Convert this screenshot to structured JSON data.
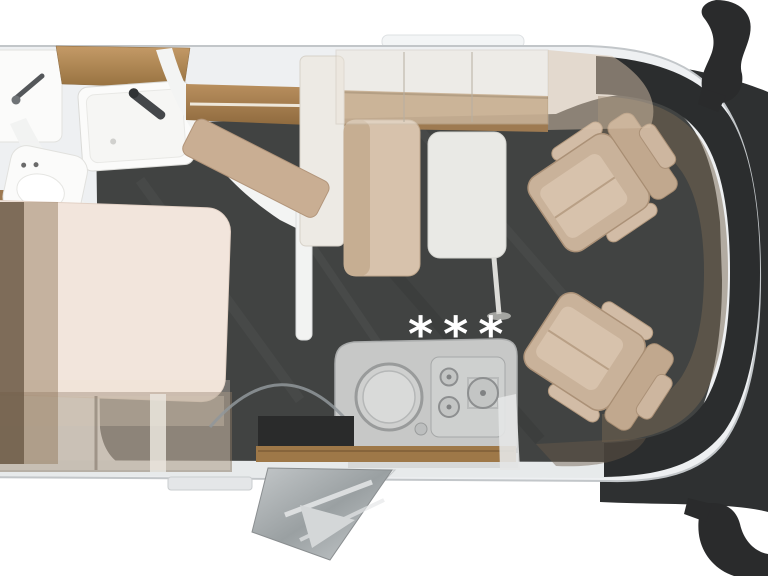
{
  "scene": {
    "type": "motorhome-floorplan-overhead-render",
    "vehicle_front": "right",
    "vehicle_rear": "left-cropped"
  },
  "kitchen": {
    "hob_symbols": "***",
    "items": [
      "counter",
      "round-sink",
      "hob-3-burner"
    ]
  },
  "areas": {
    "bathroom": {
      "items": [
        "washbasin",
        "vanity-cabinet",
        "shower-tray",
        "shower-faucet",
        "toilet",
        "partition-wall"
      ]
    },
    "bedroom": {
      "items": [
        "bed",
        "wardrobe",
        "storage-shelves"
      ]
    },
    "lounge": {
      "items": [
        "sideboard",
        "bench-backrest",
        "bench-seat",
        "corner-cushion",
        "table",
        "overhead-lockers",
        "drop-down-bed"
      ]
    },
    "entrance": {
      "items": [
        "entry-door-open",
        "entry-step",
        "wood-threshold",
        "door-swing-arc"
      ]
    },
    "cab": {
      "items": [
        "driver-swivel-seat",
        "passenger-swivel-seat",
        "dashboard",
        "windshield-band",
        "side-mirror-top",
        "side-mirror-bottom"
      ]
    }
  },
  "colors": {
    "background": "#ffffff",
    "body": "#eef0f2",
    "body_outline": "#c2c6c9",
    "carpet": "#414342",
    "glass": "#2b2d2e",
    "hood": "#2e3031",
    "mirror": "#2a2b2c",
    "dashboard": "#75654f",
    "wood": "#b5895a",
    "wood_dark": "#8f6a3e",
    "upholstery": "#c9b29a",
    "upholstery_light": "#d7c2ac",
    "bed": "#f2e5dc",
    "table": "#e9e9e5",
    "steel": "#c7c8c7",
    "white_fixture": "#fbfbfa",
    "symbol": "#ffffff"
  }
}
